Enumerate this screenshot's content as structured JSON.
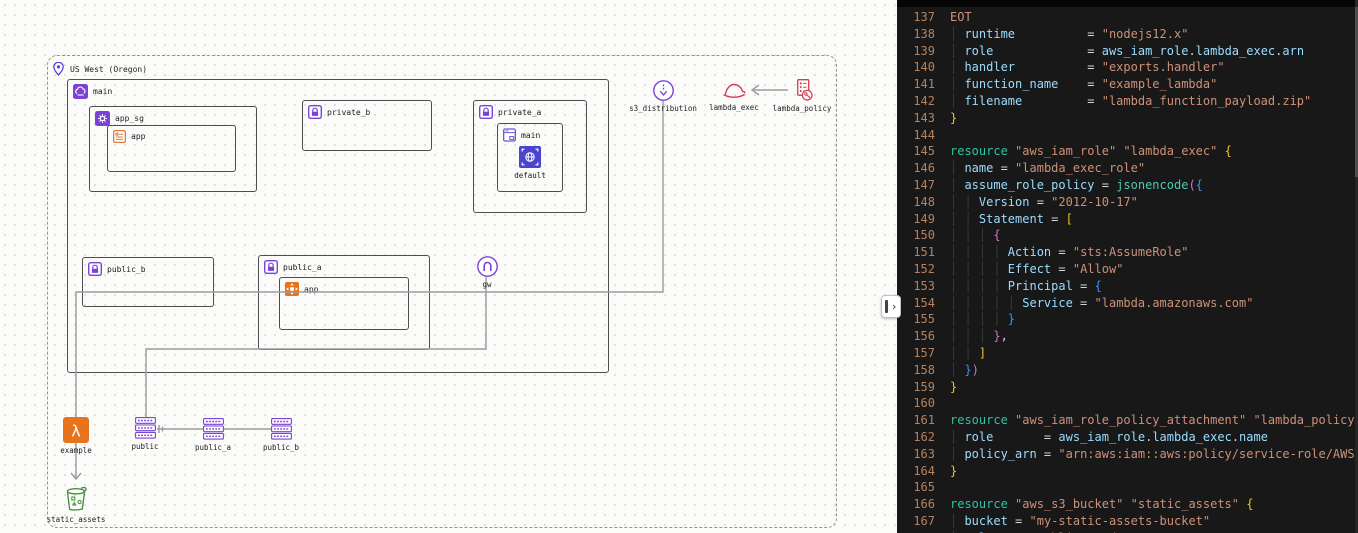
{
  "diagram": {
    "region": {
      "label": "US West (Oregon)",
      "icon": "location-pin-icon"
    },
    "vpc": {
      "label": "main",
      "icon": "vpc-icon"
    },
    "app_sg": {
      "label": "app_sg",
      "icon": "security-group-icon"
    },
    "app_template": {
      "label": "app",
      "icon": "launch-template-icon"
    },
    "private_b": {
      "label": "private_b",
      "icon": "subnet-lock-icon"
    },
    "private_a": {
      "label": "private_a",
      "icon": "subnet-lock-icon"
    },
    "private_a_main": {
      "label": "main",
      "icon": "console-window-icon"
    },
    "private_a_default": {
      "label": "default",
      "icon": "vpc-endpoint-icon"
    },
    "public_b": {
      "label": "public_b",
      "icon": "subnet-lock-icon"
    },
    "public_a": {
      "label": "public_a",
      "icon": "subnet-lock-icon"
    },
    "app_instance": {
      "label": "app",
      "icon": "ec2-instance-icon"
    },
    "gw": {
      "label": "gw",
      "icon": "internet-gateway-icon"
    },
    "s3_distribution": {
      "label": "s3_distribution",
      "icon": "cloudfront-distribution-icon"
    },
    "lambda_exec": {
      "label": "lambda_exec",
      "icon": "iam-role-icon"
    },
    "lambda_policy": {
      "label": "lambda_policy",
      "icon": "iam-policy-icon"
    },
    "example": {
      "label": "example",
      "icon": "lambda-icon"
    },
    "rt_public": {
      "label": "public",
      "icon": "route-table-icon"
    },
    "rt_public_a": {
      "label": "public_a",
      "icon": "route-table-icon"
    },
    "rt_public_b": {
      "label": "public_b",
      "icon": "route-table-icon"
    }
  },
  "static_assets": {
    "label": "static_assets",
    "icon": "s3-bucket-icon"
  },
  "divider": {
    "chevron": "›"
  },
  "colors": {
    "purple": "#7a42d6",
    "indigo": "#4c43cf",
    "orange": "#e8731d",
    "orange_outline": "#e07b39",
    "red": "#d63b4f",
    "green": "#3f8f33",
    "canvas": "#fbfbfa",
    "editor_bg": "#181818",
    "line_number": "#b5825e",
    "string": "#ce9178",
    "property": "#9cdcfe",
    "keyword": "#2dc5a2",
    "function": "#4ec9b0",
    "bracket_yellow": "#e9c62b",
    "bracket_pink": "#d670d6",
    "bracket_blue": "#3794ff"
  },
  "code": {
    "lines": [
      {
        "n": 137,
        "g": 0,
        "t": [
          [
            "EOT",
            "s"
          ]
        ]
      },
      {
        "n": 138,
        "g": 1,
        "t": [
          [
            "runtime",
            "p"
          ],
          [
            "          = ",
            "w"
          ],
          [
            "\"nodejs12.x\"",
            "s"
          ]
        ]
      },
      {
        "n": 139,
        "g": 1,
        "t": [
          [
            "role",
            "p"
          ],
          [
            "             = ",
            "w"
          ],
          [
            "aws_iam_role",
            "p"
          ],
          [
            ".",
            "w"
          ],
          [
            "lambda_exec",
            "p"
          ],
          [
            ".",
            "w"
          ],
          [
            "arn",
            "p"
          ]
        ]
      },
      {
        "n": 140,
        "g": 1,
        "t": [
          [
            "handler",
            "p"
          ],
          [
            "          = ",
            "w"
          ],
          [
            "\"exports.handler\"",
            "s"
          ]
        ]
      },
      {
        "n": 141,
        "g": 1,
        "t": [
          [
            "function_name",
            "p"
          ],
          [
            "    = ",
            "w"
          ],
          [
            "\"example_lambda\"",
            "s"
          ]
        ]
      },
      {
        "n": 142,
        "g": 1,
        "t": [
          [
            "filename",
            "p"
          ],
          [
            "         = ",
            "w"
          ],
          [
            "\"lambda_function_payload.zip\"",
            "s"
          ]
        ]
      },
      {
        "n": 143,
        "g": 0,
        "t": [
          [
            "}",
            "y"
          ]
        ]
      },
      {
        "n": 144,
        "g": 0,
        "t": []
      },
      {
        "n": 145,
        "g": 0,
        "t": [
          [
            "resource",
            "k"
          ],
          [
            " ",
            "w"
          ],
          [
            "\"aws_iam_role\"",
            "s"
          ],
          [
            " ",
            "w"
          ],
          [
            "\"lambda_exec\"",
            "s"
          ],
          [
            " ",
            "w"
          ],
          [
            "{",
            "y"
          ]
        ]
      },
      {
        "n": 146,
        "g": 1,
        "t": [
          [
            "name",
            "p"
          ],
          [
            " = ",
            "w"
          ],
          [
            "\"lambda_exec_role\"",
            "s"
          ]
        ]
      },
      {
        "n": 147,
        "g": 1,
        "t": [
          [
            "assume_role_policy",
            "p"
          ],
          [
            " = ",
            "w"
          ],
          [
            "jsonencode",
            "f"
          ],
          [
            "(",
            "m"
          ],
          [
            "{",
            "b"
          ]
        ]
      },
      {
        "n": 148,
        "g": 2,
        "t": [
          [
            "Version",
            "p"
          ],
          [
            " = ",
            "w"
          ],
          [
            "\"2012-10-17\"",
            "s"
          ]
        ]
      },
      {
        "n": 149,
        "g": 2,
        "t": [
          [
            "Statement",
            "p"
          ],
          [
            " = ",
            "w"
          ],
          [
            "[",
            "y"
          ]
        ]
      },
      {
        "n": 150,
        "g": 3,
        "t": [
          [
            "{",
            "m"
          ]
        ]
      },
      {
        "n": 151,
        "g": 4,
        "t": [
          [
            "Action",
            "p"
          ],
          [
            " = ",
            "w"
          ],
          [
            "\"sts:AssumeRole\"",
            "s"
          ]
        ]
      },
      {
        "n": 152,
        "g": 4,
        "t": [
          [
            "Effect",
            "p"
          ],
          [
            " = ",
            "w"
          ],
          [
            "\"Allow\"",
            "s"
          ]
        ]
      },
      {
        "n": 153,
        "g": 4,
        "t": [
          [
            "Principal",
            "p"
          ],
          [
            " = ",
            "w"
          ],
          [
            "{",
            "b"
          ]
        ]
      },
      {
        "n": 154,
        "g": 5,
        "t": [
          [
            "Service",
            "p"
          ],
          [
            " = ",
            "w"
          ],
          [
            "\"lambda.amazonaws.com\"",
            "s"
          ]
        ]
      },
      {
        "n": 155,
        "g": 4,
        "t": [
          [
            "}",
            "b"
          ]
        ]
      },
      {
        "n": 156,
        "g": 3,
        "t": [
          [
            "}",
            "m"
          ],
          [
            ",",
            "w"
          ]
        ]
      },
      {
        "n": 157,
        "g": 2,
        "t": [
          [
            "]",
            "y"
          ]
        ]
      },
      {
        "n": 158,
        "g": 1,
        "t": [
          [
            "}",
            "b"
          ],
          [
            ")",
            "m"
          ]
        ]
      },
      {
        "n": 159,
        "g": 0,
        "t": [
          [
            "}",
            "y"
          ]
        ]
      },
      {
        "n": 160,
        "g": 0,
        "t": []
      },
      {
        "n": 161,
        "g": 0,
        "t": [
          [
            "resource",
            "k"
          ],
          [
            " ",
            "w"
          ],
          [
            "\"aws_iam_role_policy_attachment\"",
            "s"
          ],
          [
            " ",
            "w"
          ],
          [
            "\"lambda_policy\"",
            "s"
          ],
          [
            " ",
            "w"
          ],
          [
            "{",
            "y"
          ]
        ]
      },
      {
        "n": 162,
        "g": 1,
        "t": [
          [
            "role",
            "p"
          ],
          [
            "       = ",
            "w"
          ],
          [
            "aws_iam_role",
            "p"
          ],
          [
            ".",
            "w"
          ],
          [
            "lambda_exec",
            "p"
          ],
          [
            ".",
            "w"
          ],
          [
            "name",
            "p"
          ]
        ]
      },
      {
        "n": 163,
        "g": 1,
        "t": [
          [
            "policy_arn",
            "p"
          ],
          [
            " = ",
            "w"
          ],
          [
            "\"arn:aws:iam::aws:policy/service-role/AWSL",
            "s"
          ]
        ]
      },
      {
        "n": 164,
        "g": 0,
        "t": [
          [
            "}",
            "y"
          ]
        ]
      },
      {
        "n": 165,
        "g": 0,
        "t": []
      },
      {
        "n": 166,
        "g": 0,
        "t": [
          [
            "resource",
            "k"
          ],
          [
            " ",
            "w"
          ],
          [
            "\"aws_s3_bucket\"",
            "s"
          ],
          [
            " ",
            "w"
          ],
          [
            "\"static_assets\"",
            "s"
          ],
          [
            " ",
            "w"
          ],
          [
            "{",
            "y"
          ]
        ]
      },
      {
        "n": 167,
        "g": 1,
        "t": [
          [
            "bucket",
            "p"
          ],
          [
            " = ",
            "w"
          ],
          [
            "\"my-static-assets-bucket\"",
            "s"
          ]
        ]
      },
      {
        "n": 168,
        "g": 1,
        "t": [
          [
            "acl",
            "p"
          ],
          [
            "    = ",
            "w"
          ],
          [
            "\"public-read\"",
            "s"
          ]
        ]
      }
    ]
  }
}
